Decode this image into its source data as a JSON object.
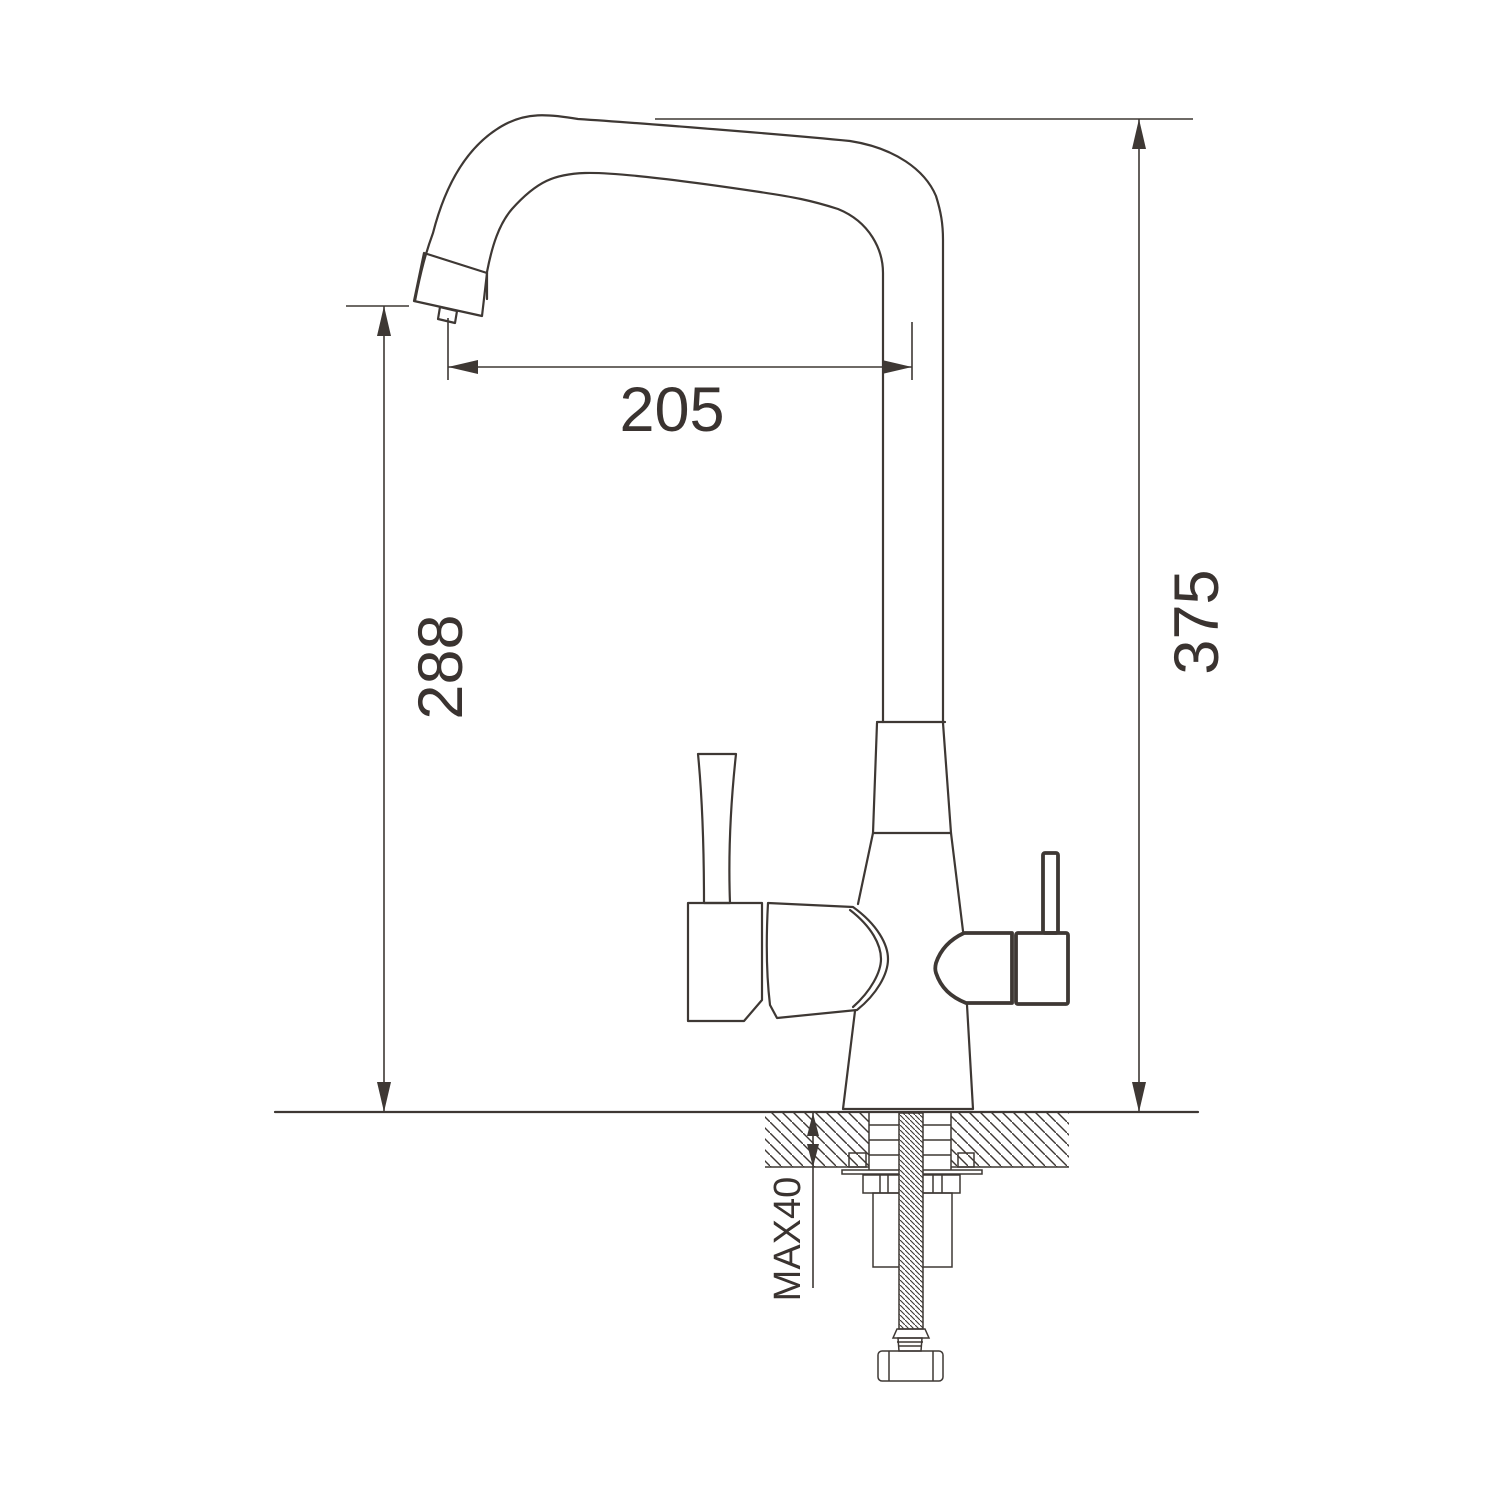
{
  "drawing": {
    "background_color": "#ffffff",
    "line_color": "#3e3834",
    "text_color": "#3a3330",
    "labels": {
      "spout_reach": "205",
      "spout_outlet_height": "288",
      "overall_height": "375",
      "max_mounting_thickness": "MAX40"
    }
  }
}
